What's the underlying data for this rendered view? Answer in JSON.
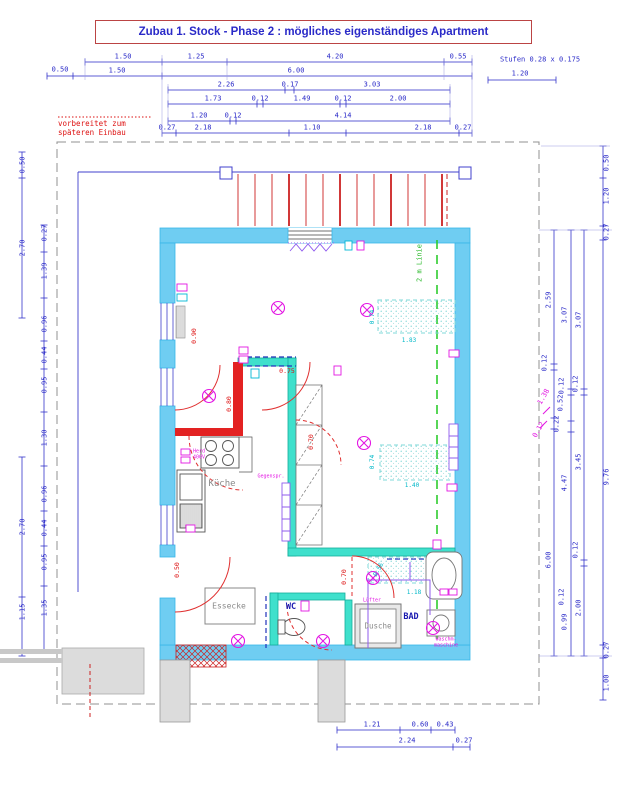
{
  "title": "Zubau 1. Stock - Phase 2 : mögliches eigenständiges Apartment",
  "annotations": {
    "prepared_line1": "vorbereitet zum",
    "prepared_line2": "späteren Einbau",
    "stairs_note": "Stufen 0.28 x 0.175",
    "two_m_line": "2 m Linie"
  },
  "rooms": {
    "kitchen": "Küche",
    "dining": "Essecke",
    "wc": "WC",
    "bath": "BAD",
    "shower": "Dusche"
  },
  "appliances": {
    "stove": "Herd",
    "stove_power": "400V",
    "intercom": "Gegenspr.",
    "fan": "Lüfter",
    "washer_line1": "Waschm-",
    "washer_line2": "maschine"
  },
  "colors": {
    "dim_blue": "#2a2ac8",
    "wall_cyan": "#6fcdf2",
    "partition_teal": "#3fe0cc",
    "new_wall_red": "#e32222",
    "symbol_magenta": "#e316e3",
    "guide_green": "#2ecc2e",
    "note_red": "#dd1111",
    "dim_cyan": "#00b8c8"
  },
  "dimension_labels": [
    {
      "t": "1.50",
      "x": 123,
      "y": 57
    },
    {
      "t": "1.25",
      "x": 196,
      "y": 57
    },
    {
      "t": "4.20",
      "x": 335,
      "y": 57
    },
    {
      "t": "0.55",
      "x": 458,
      "y": 57
    },
    {
      "t": "0.50",
      "x": 60,
      "y": 70
    },
    {
      "t": "1.50",
      "x": 117,
      "y": 71
    },
    {
      "t": "6.00",
      "x": 296,
      "y": 71
    },
    {
      "t": "1.20",
      "x": 520,
      "y": 74
    },
    {
      "t": "2.26",
      "x": 226,
      "y": 85
    },
    {
      "t": "0.17",
      "x": 290,
      "y": 85
    },
    {
      "t": "3.03",
      "x": 372,
      "y": 85
    },
    {
      "t": "1.73",
      "x": 213,
      "y": 99
    },
    {
      "t": "0.12",
      "x": 260,
      "y": 99
    },
    {
      "t": "1.49",
      "x": 302,
      "y": 99
    },
    {
      "t": "0.12",
      "x": 343,
      "y": 99
    },
    {
      "t": "2.00",
      "x": 398,
      "y": 99
    },
    {
      "t": "1.20",
      "x": 199,
      "y": 116
    },
    {
      "t": "0.12",
      "x": 233,
      "y": 116
    },
    {
      "t": "4.14",
      "x": 343,
      "y": 116
    },
    {
      "t": "0.27",
      "x": 167,
      "y": 128
    },
    {
      "t": "2.18",
      "x": 203,
      "y": 128
    },
    {
      "t": "1.10",
      "x": 312,
      "y": 128
    },
    {
      "t": "2.18",
      "x": 423,
      "y": 128
    },
    {
      "t": "0.27",
      "x": 463,
      "y": 128
    },
    {
      "t": "0.50",
      "x": 23,
      "y": 165,
      "r": -90
    },
    {
      "t": "2.70",
      "x": 23,
      "y": 248,
      "r": -90
    },
    {
      "t": "2.70",
      "x": 23,
      "y": 527,
      "r": -90
    },
    {
      "t": "1.15",
      "x": 23,
      "y": 612,
      "r": -90
    },
    {
      "t": "0.27",
      "x": 45,
      "y": 233,
      "r": -90
    },
    {
      "t": "1.39",
      "x": 45,
      "y": 271,
      "r": -90
    },
    {
      "t": "0.96",
      "x": 45,
      "y": 324,
      "r": -90
    },
    {
      "t": "0.44",
      "x": 45,
      "y": 355,
      "r": -90
    },
    {
      "t": "0.95",
      "x": 45,
      "y": 385,
      "r": -90
    },
    {
      "t": "1.30",
      "x": 45,
      "y": 438,
      "r": -90
    },
    {
      "t": "0.96",
      "x": 45,
      "y": 494,
      "r": -90
    },
    {
      "t": "0.44",
      "x": 45,
      "y": 528,
      "r": -90
    },
    {
      "t": "0.95",
      "x": 45,
      "y": 562,
      "r": -90
    },
    {
      "t": "1.35",
      "x": 45,
      "y": 608,
      "r": -90
    },
    {
      "t": "2.59",
      "x": 549,
      "y": 300,
      "r": -90
    },
    {
      "t": "0.12",
      "x": 545,
      "y": 363,
      "r": -90
    },
    {
      "t": "0.22",
      "x": 557,
      "y": 424,
      "r": -90
    },
    {
      "t": "6.00",
      "x": 549,
      "y": 560,
      "r": -90
    },
    {
      "t": "3.07",
      "x": 565,
      "y": 315,
      "r": -90
    },
    {
      "t": "0.12",
      "x": 562,
      "y": 386,
      "r": -90
    },
    {
      "t": "0.52",
      "x": 561,
      "y": 403,
      "r": -90
    },
    {
      "t": "4.47",
      "x": 565,
      "y": 483,
      "r": -90
    },
    {
      "t": "0.12",
      "x": 562,
      "y": 597,
      "r": -90
    },
    {
      "t": "0.99",
      "x": 565,
      "y": 622,
      "r": -90
    },
    {
      "t": "3.07",
      "x": 579,
      "y": 320,
      "r": -90
    },
    {
      "t": "0.12",
      "x": 576,
      "y": 384,
      "r": -90
    },
    {
      "t": "3.45",
      "x": 579,
      "y": 462,
      "r": -90
    },
    {
      "t": "0.12",
      "x": 576,
      "y": 550,
      "r": -90
    },
    {
      "t": "2.00",
      "x": 579,
      "y": 608,
      "r": -90
    },
    {
      "t": "0.50",
      "x": 607,
      "y": 163,
      "r": -90
    },
    {
      "t": "1.20",
      "x": 607,
      "y": 196,
      "r": -90
    },
    {
      "t": "0.27",
      "x": 607,
      "y": 232,
      "r": -90
    },
    {
      "t": "9.76",
      "x": 607,
      "y": 477,
      "r": -90
    },
    {
      "t": "0.27",
      "x": 607,
      "y": 650,
      "r": -90
    },
    {
      "t": "1.00",
      "x": 607,
      "y": 683,
      "r": -90
    },
    {
      "t": "1.38",
      "x": 544,
      "y": 397,
      "r": -60,
      "c": "m"
    },
    {
      "t": "0.12",
      "x": 539,
      "y": 430,
      "r": -60,
      "c": "m"
    },
    {
      "t": "1.21",
      "x": 372,
      "y": 725
    },
    {
      "t": "0.60",
      "x": 420,
      "y": 725
    },
    {
      "t": "0.43",
      "x": 445,
      "y": 725
    },
    {
      "t": "2.24",
      "x": 407,
      "y": 741
    },
    {
      "t": "0.27",
      "x": 464,
      "y": 741
    },
    {
      "t": "0.90",
      "x": 194,
      "y": 336,
      "r": -90,
      "c": "r"
    },
    {
      "t": "0.75",
      "x": 287,
      "y": 371,
      "c": "r"
    },
    {
      "t": "0.80",
      "x": 229,
      "y": 404,
      "r": -90,
      "c": "r"
    },
    {
      "t": "0.70",
      "x": 311,
      "y": 442,
      "r": -90,
      "c": "r"
    },
    {
      "t": "0.70",
      "x": 344,
      "y": 577,
      "r": -90,
      "c": "r"
    },
    {
      "t": "0.50",
      "x": 177,
      "y": 570,
      "r": -90,
      "c": "r"
    },
    {
      "t": "0.74",
      "x": 373,
      "y": 317,
      "r": -90,
      "c": "c2"
    },
    {
      "t": "1.83",
      "x": 409,
      "y": 341,
      "c": "c2"
    },
    {
      "t": "0.74",
      "x": 373,
      "y": 462,
      "r": -90,
      "c": "c2"
    },
    {
      "t": "1.40",
      "x": 412,
      "y": 486,
      "c": "c2"
    },
    {
      "t": "1.18",
      "x": 414,
      "y": 593,
      "c": "c2"
    },
    {
      "t": "0.56",
      "x": 379,
      "y": 570,
      "r": -60,
      "c": "c2"
    }
  ]
}
